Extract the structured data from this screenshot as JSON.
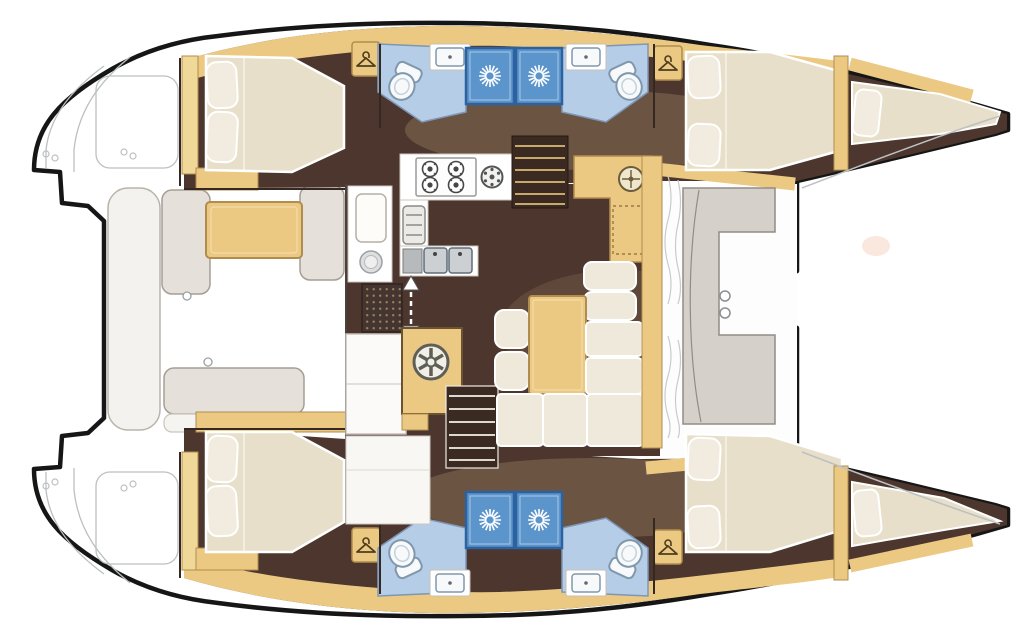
{
  "meta": {
    "title": "Catamaran interior layout — top-down floor plan, bow to the right, stern with swim-platform steps to the left",
    "diagram_type": "boat-floor-plan",
    "vessel_type": "catamaran",
    "bow_direction": "right",
    "stern_direction": "left"
  },
  "counts": {
    "double_cabins": 4,
    "heads": 4,
    "shower_stalls": 4,
    "bow_berths": 2,
    "companionway_stairs": 2
  },
  "areas": {
    "port_hull_top": [
      "aft-double-cabin",
      "aft-head",
      "forward-head",
      "forward-double-cabin",
      "bow-berth"
    ],
    "starboard_hull_bottom": [
      "aft-double-cabin",
      "aft-head",
      "forward-head",
      "forward-double-cabin",
      "bow-berth"
    ],
    "salon_center": [
      "l-shaped-galley",
      "four-burner-stove",
      "round-burner",
      "oven",
      "double-sink",
      "round-sink",
      "companionway-stairs-port",
      "companionway-stairs-starboard",
      "nav-station",
      "dinette-table",
      "stools",
      "l-shaped-sofa",
      "forward-facing-seat"
    ],
    "exterior": [
      "stern-swim-platform-steps",
      "aft-cockpit-benches",
      "cockpit-table",
      "foredeck"
    ]
  },
  "icons": [
    "shower-sunburst-icon",
    "coat-hanger-icon",
    "toilet-icon",
    "sink-icon",
    "stove-burner-icon",
    "wok-burner-icon",
    "oven-icon",
    "double-sink-icon",
    "compass-icon",
    "spoke-wheel-icon",
    "up-down-arrow-icon",
    "floor-grate-icon"
  ],
  "colors": {
    "outline": "#161616",
    "deckline": "#bcc0c2",
    "floor": "#4c362e",
    "floorShadow": "#8c7157",
    "cabinet": "#ecc983",
    "cabinetEdge": "#b08d4e",
    "mattress": "#e7dfca",
    "pillow": "#f1ecdf",
    "bathFloor": "#b6cde7",
    "bathEdge": "#7d97b5",
    "shower": "#5b95cb",
    "showerEdge": "#2d62a0",
    "fixture": "#f7f9fa",
    "fixtureEdge": "#8098ad",
    "cushion": "#e5e1da",
    "cushionEdge": "#a59e94",
    "sofa": "#efe9dc",
    "stairTread": "#c9a96b",
    "paper": "#ffffff"
  }
}
